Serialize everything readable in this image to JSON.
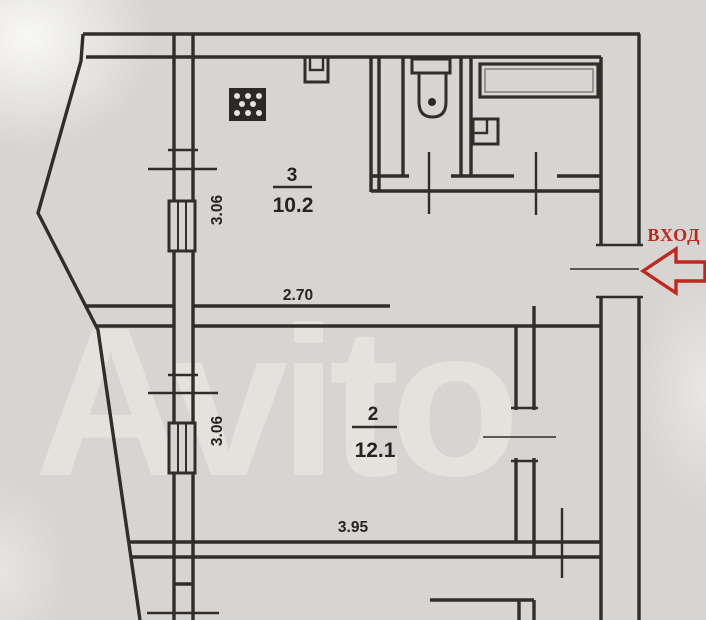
{
  "colors": {
    "paper": "#d7d5d1",
    "ink": "#312e2a",
    "accent_red": "#c1271c"
  },
  "watermark": "Avito",
  "entrance": {
    "label": "ВХОД",
    "arrow_icon": "arrow-left-outline"
  },
  "rooms": {
    "room3": {
      "number": "3",
      "area": "10.2"
    },
    "room2": {
      "number": "2",
      "area": "12.1"
    }
  },
  "dimensions": {
    "left_wall_upper": "3.06",
    "left_wall_lower": "3.06",
    "room2_top_width": "2.70",
    "room2_bottom_width": "3.95"
  },
  "fixtures": {
    "kitchen": "stove-icon",
    "wc": "toilet-icon",
    "bathroom": [
      "bathtub-icon",
      "sink-icon"
    ],
    "duct": "vent-icon"
  }
}
